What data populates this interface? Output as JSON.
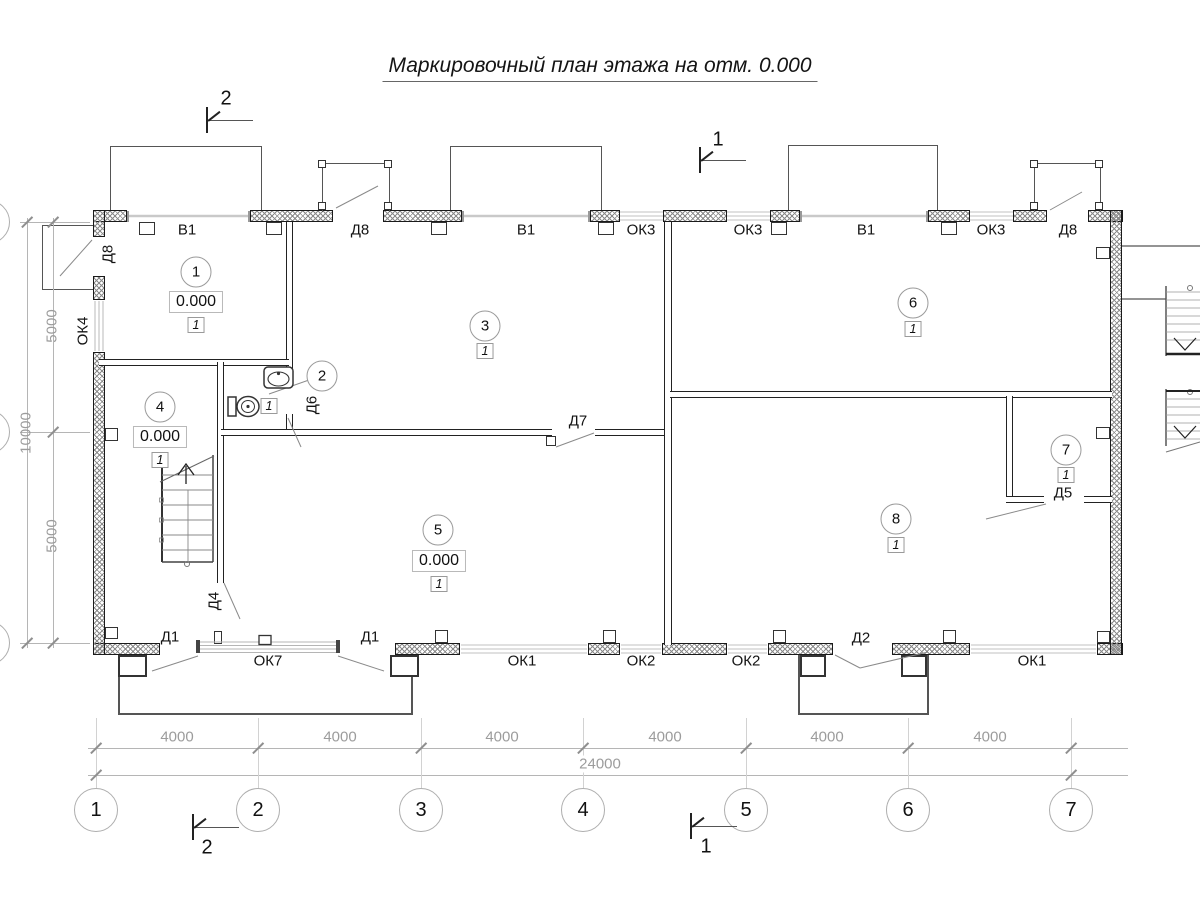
{
  "title": "Маркировочный план этажа на отм. 0.000",
  "colors": {
    "wall_line": "#1a1a1a",
    "dim_gray": "#9c9c9c",
    "thin_gray": "#8a8a8a"
  },
  "rooms": [
    {
      "number": "1",
      "x": 196,
      "y": 272,
      "elevation": "0.000",
      "elev_x": 196,
      "elev_y": 302,
      "unit": "1",
      "unit_x": 196,
      "unit_y": 325
    },
    {
      "number": "2",
      "x": 322,
      "y": 376,
      "unit": "1",
      "unit_x": 269,
      "unit_y": 406
    },
    {
      "number": "3",
      "x": 485,
      "y": 326,
      "unit": "1",
      "unit_x": 485,
      "unit_y": 351
    },
    {
      "number": "4",
      "x": 160,
      "y": 407,
      "elevation": "0.000",
      "elev_x": 160,
      "elev_y": 437,
      "unit": "1",
      "unit_x": 160,
      "unit_y": 460
    },
    {
      "number": "5",
      "x": 438,
      "y": 530,
      "elevation": "0.000",
      "elev_x": 439,
      "elev_y": 561,
      "unit": "1",
      "unit_x": 439,
      "unit_y": 584
    },
    {
      "number": "6",
      "x": 913,
      "y": 303,
      "unit": "1",
      "unit_x": 913,
      "unit_y": 329
    },
    {
      "number": "7",
      "x": 1066,
      "y": 450,
      "unit": "1",
      "unit_x": 1066,
      "unit_y": 475
    },
    {
      "number": "8",
      "x": 896,
      "y": 519,
      "unit": "1",
      "unit_x": 896,
      "unit_y": 545
    }
  ],
  "wall_labels": [
    {
      "text": "В1",
      "x": 187,
      "y": 230
    },
    {
      "text": "Д8",
      "x": 360,
      "y": 230
    },
    {
      "text": "В1",
      "x": 526,
      "y": 230
    },
    {
      "text": "ОК3",
      "x": 641,
      "y": 230
    },
    {
      "text": "ОК3",
      "x": 748,
      "y": 230
    },
    {
      "text": "В1",
      "x": 866,
      "y": 230
    },
    {
      "text": "ОК3",
      "x": 991,
      "y": 230
    },
    {
      "text": "Д8",
      "x": 1068,
      "y": 230
    },
    {
      "text": "Д8",
      "x": 108,
      "y": 254,
      "rotate": -90
    },
    {
      "text": "ОК4",
      "x": 83,
      "y": 331,
      "rotate": -90
    },
    {
      "text": "Д6",
      "x": 312,
      "y": 405,
      "rotate": -90
    },
    {
      "text": "Д7",
      "x": 578,
      "y": 421
    },
    {
      "text": "Д5",
      "x": 1063,
      "y": 493
    },
    {
      "text": "Д4",
      "x": 214,
      "y": 601,
      "rotate": -90
    },
    {
      "text": "Д1",
      "x": 170,
      "y": 637
    },
    {
      "text": "Д1",
      "x": 370,
      "y": 637
    },
    {
      "text": "Д2",
      "x": 861,
      "y": 638
    },
    {
      "text": "ОК7",
      "x": 268,
      "y": 661
    },
    {
      "text": "ОК1",
      "x": 522,
      "y": 661
    },
    {
      "text": "ОК2",
      "x": 641,
      "y": 661
    },
    {
      "text": "ОК2",
      "x": 746,
      "y": 661
    },
    {
      "text": "ОК1",
      "x": 1032,
      "y": 661
    }
  ],
  "section_marks": [
    {
      "label": "2",
      "x": 207,
      "y": 120,
      "num_x": 226,
      "num_y": 99
    },
    {
      "label": "1",
      "x": 700,
      "y": 160,
      "num_x": 718,
      "num_y": 140
    },
    {
      "label": "2",
      "x": 193,
      "y": 827,
      "num_x": 207,
      "num_y": 848
    },
    {
      "label": "1",
      "x": 691,
      "y": 826,
      "num_x": 706,
      "num_y": 847
    }
  ],
  "grid": {
    "axes": [
      {
        "label": "1",
        "x": 96
      },
      {
        "label": "2",
        "x": 258
      },
      {
        "label": "3",
        "x": 421
      },
      {
        "label": "4",
        "x": 583
      },
      {
        "label": "5",
        "x": 746
      },
      {
        "label": "6",
        "x": 908
      },
      {
        "label": "7",
        "x": 1071
      }
    ],
    "circle_y": 810,
    "bay_dims": [
      {
        "text": "4000",
        "x": 177
      },
      {
        "text": "4000",
        "x": 340
      },
      {
        "text": "4000",
        "x": 502
      },
      {
        "text": "4000",
        "x": 665
      },
      {
        "text": "4000",
        "x": 827
      },
      {
        "text": "4000",
        "x": 990
      }
    ],
    "bay_dim_y": 737,
    "total_dim": {
      "text": "24000",
      "x": 600,
      "y": 764
    },
    "left_dims": [
      {
        "text": "5000",
        "x": 52,
        "y": 326
      },
      {
        "text": "10000",
        "x": 26,
        "y": 433
      },
      {
        "text": "5000",
        "x": 52,
        "y": 536
      }
    ]
  }
}
